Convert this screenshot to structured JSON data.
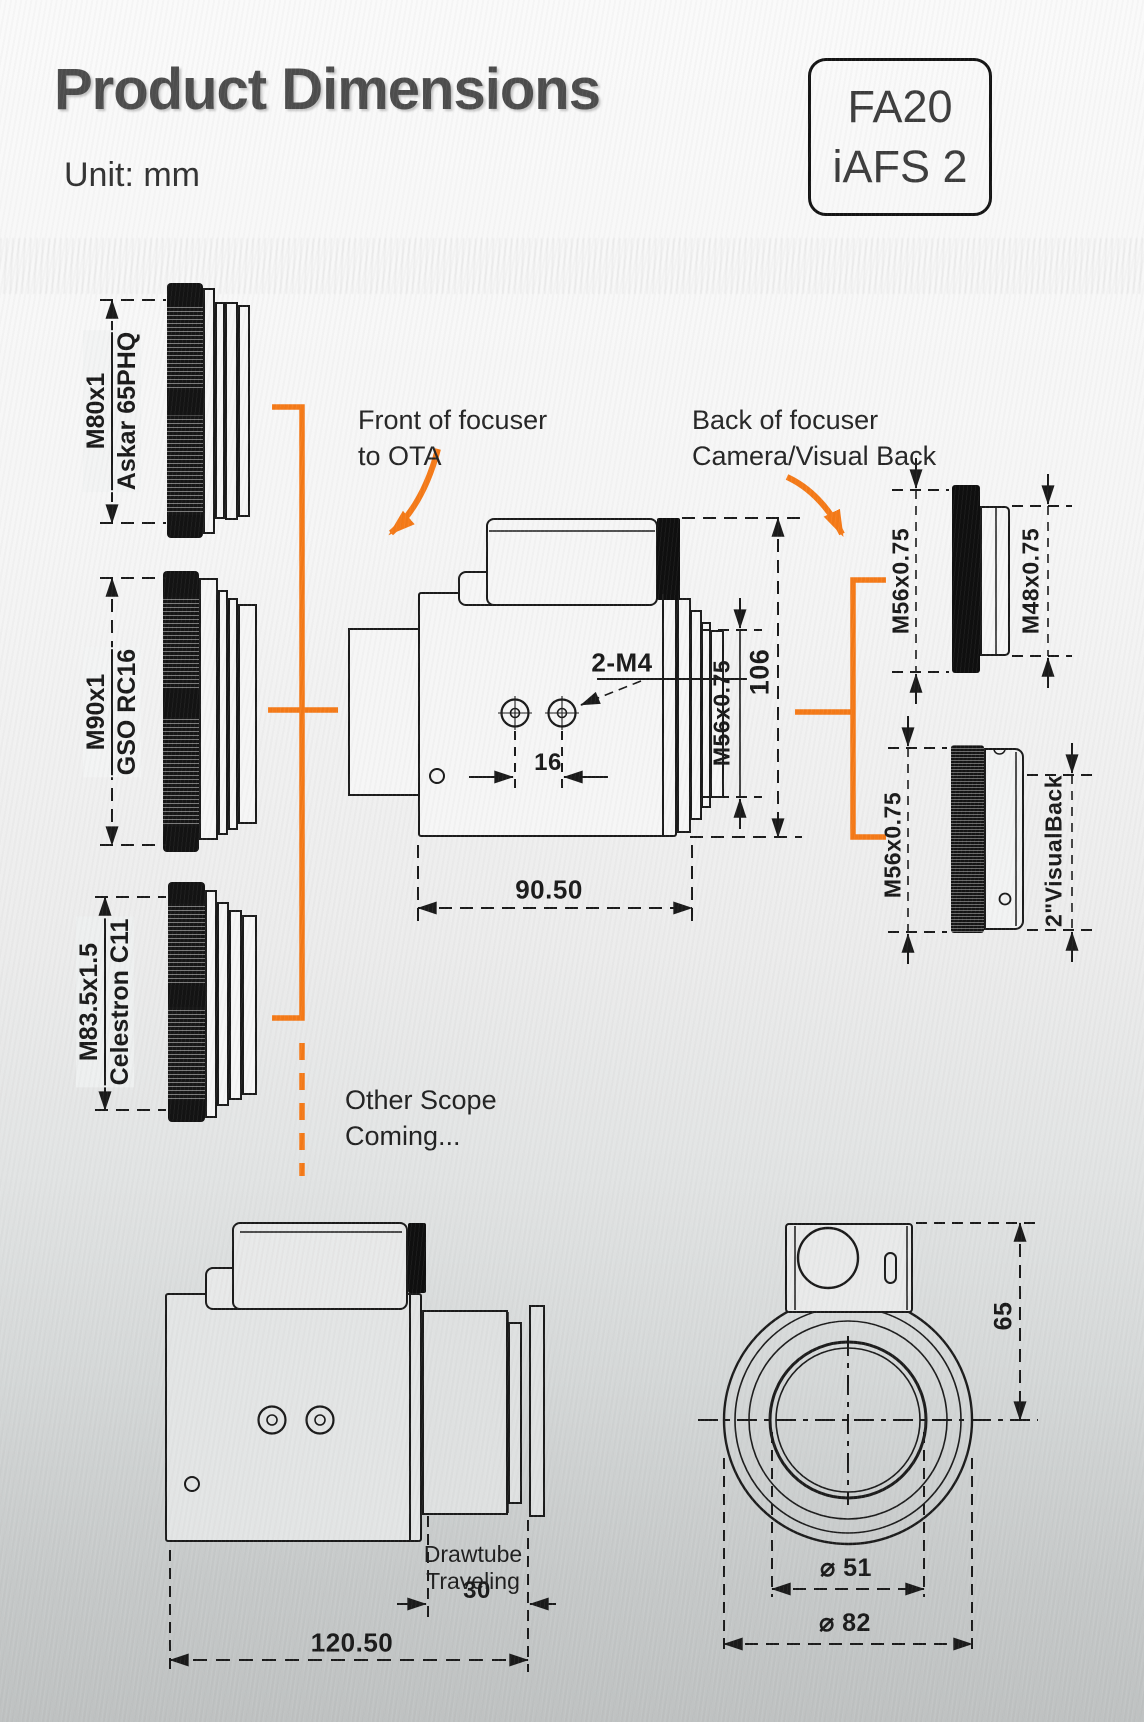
{
  "header": {
    "title": "Product Dimensions",
    "unit_label": "Unit: mm",
    "model_badge": {
      "line1": "FA20",
      "line2": "iAFS 2"
    }
  },
  "annotations": {
    "front_arrow_label": {
      "line1": "Front of focuser",
      "line2": "to OTA"
    },
    "back_arrow_label": {
      "line1": "Back of focuser",
      "line2": "Camera/Visual Back"
    },
    "other_scope": {
      "line1": "Other Scope",
      "line2": "Coming..."
    }
  },
  "front_adapters": [
    {
      "thread": "M80x1",
      "scope": "Askar 65PHQ"
    },
    {
      "thread": "M90x1",
      "scope": "GSO RC16"
    },
    {
      "thread": "M83.5x1.5",
      "scope": "Celestron C11"
    }
  ],
  "back_adapters": [
    {
      "focuser_side_thread": "M56x0.75",
      "camera_side_thread": "M48x0.75"
    },
    {
      "focuser_side_thread": "M56x0.75",
      "camera_side_thread": "2\"VisualBack"
    }
  ],
  "main_view": {
    "screw_callout": "2-M4",
    "screw_spacing_mm": "16",
    "drawtube_thread": "M56x0.75",
    "overall_height_mm": "106",
    "body_length_mm": "90.50"
  },
  "side_view": {
    "drawtube_label": {
      "line1": "Drawtube",
      "line2": "Traveling"
    },
    "travel_mm": "30",
    "overall_length_mm": "120.50"
  },
  "front_view": {
    "motor_offset_mm": "65",
    "inner_diameter": {
      "symbol": "⌀",
      "value": "51"
    },
    "outer_diameter": {
      "symbol": "⌀",
      "value": "82"
    }
  },
  "colors": {
    "accent_orange": "#F57A18",
    "line_color": "#1a1a1a"
  }
}
